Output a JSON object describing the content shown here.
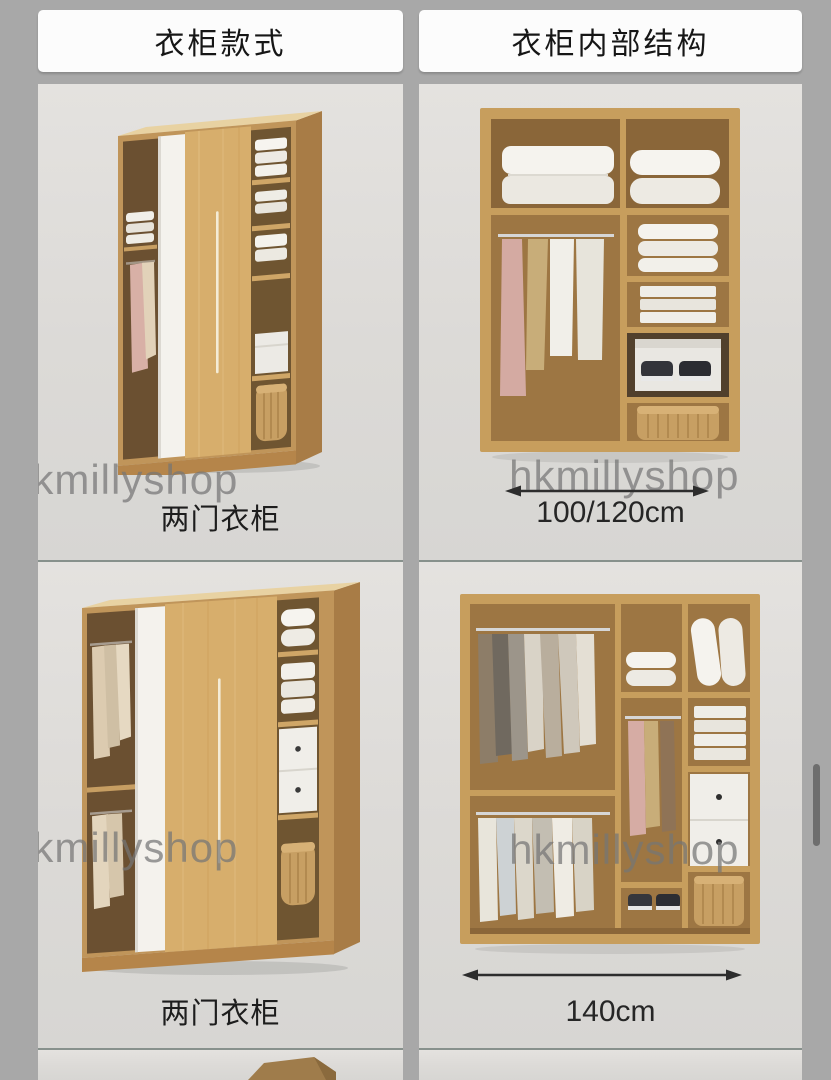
{
  "colors": {
    "page_background": "#a8a8a8",
    "card_background": "#dcdad7",
    "header_pill_background": "#fcfcfc",
    "divider": "#87918c",
    "text": "#1d1d1d",
    "watermark": "#767676",
    "wood_light": "#d7ae6c",
    "wood_frame": "#c79e5d",
    "interior_wood": "#9d7643",
    "dimension_arrow": "#2d2d2d",
    "scrollbar_thumb": "#6e6e6e"
  },
  "columns": [
    {
      "name": "wardrobe-styles",
      "header": "衣柜款式",
      "cells": [
        {
          "image_name": "two-door-sliding-wardrobe-photo",
          "caption": "两门衣柜",
          "watermark": "hkmillyshop"
        },
        {
          "image_name": "two-door-sliding-wardrobe-with-drawers-photo",
          "caption": "两门衣柜",
          "watermark": "hkmillyshop"
        }
      ]
    },
    {
      "name": "wardrobe-internal-structure",
      "header": "衣柜内部结构",
      "cells": [
        {
          "image_name": "wardrobe-interior-photo-100-120cm",
          "caption": "100/120cm",
          "watermark": "hkmillyshop",
          "dimension_arrow": true
        },
        {
          "image_name": "wardrobe-interior-photo-140cm",
          "caption": "140cm",
          "watermark": "hkmillyshop",
          "dimension_arrow": true
        }
      ]
    }
  ],
  "scrollbar": {
    "visible": true
  }
}
